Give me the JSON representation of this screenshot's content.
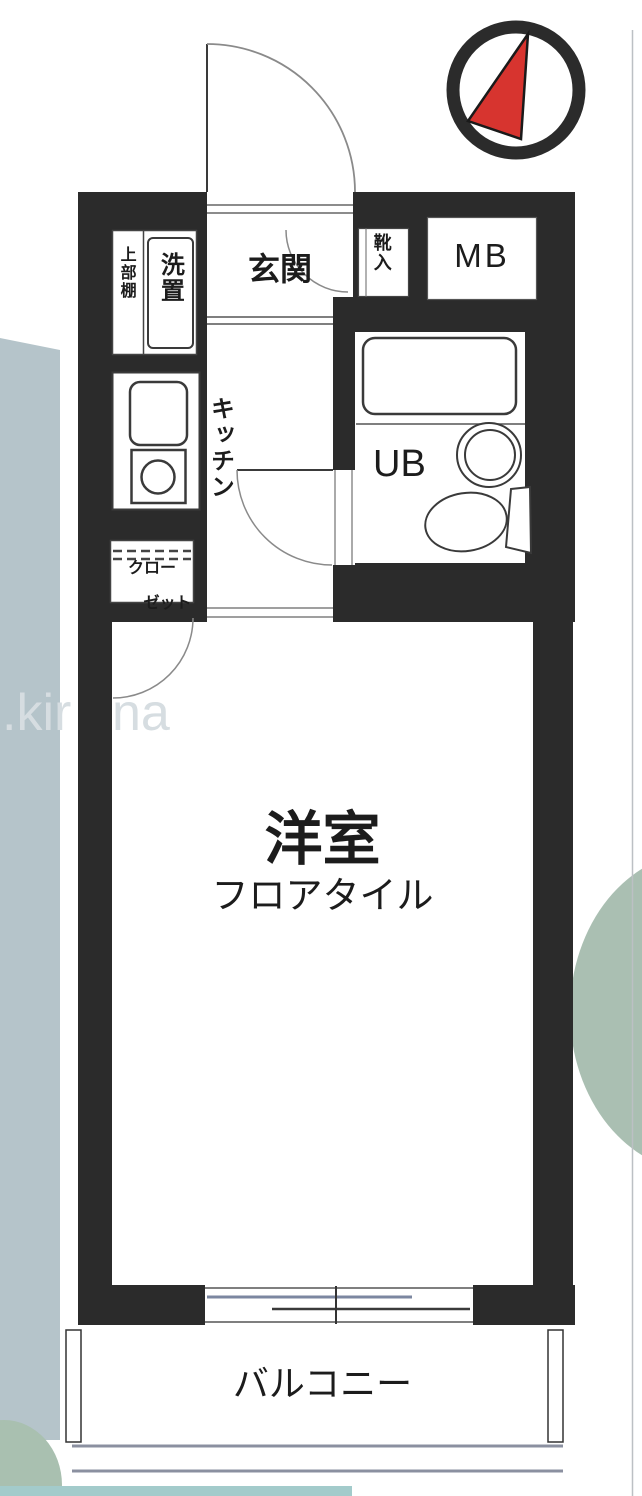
{
  "labels": {
    "genkan": "玄関",
    "shoe_storage": "靴入",
    "meter_box": "MB",
    "upper_shelf": "上部棚",
    "washer_place": "洗置",
    "kitchen": "キッチン",
    "unit_bath": "UB",
    "closet_line1": "クロー",
    "closet_line2": "ゼット",
    "room": "洋室",
    "floor_tile": "フロアタイル",
    "balcony": "バルコニー"
  },
  "watermark": {
    "part1": ".kir",
    "part2": "na"
  },
  "colors": {
    "wall": "#2b2b2b",
    "red": "#d7342f",
    "band": "#b5c4ca",
    "circle": "#aabfb2",
    "blob": "#a9c0b0",
    "teal": "#a3cbcb"
  }
}
